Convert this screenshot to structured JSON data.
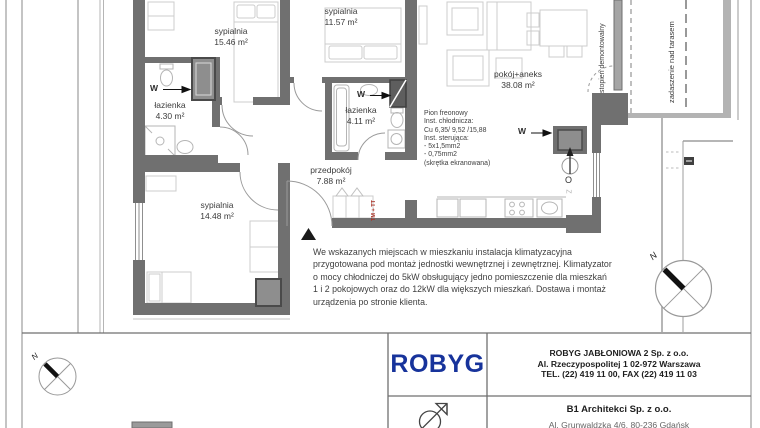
{
  "floor_plan": {
    "rooms": [
      {
        "name": "sypialnia",
        "area": "15.46 m²"
      },
      {
        "name": "sypialnia",
        "area": "11.57 m²"
      },
      {
        "name": "łazienka",
        "area": "4.30 m²"
      },
      {
        "name": "łazienka",
        "area": "4.11 m²"
      },
      {
        "name": "sypialnia",
        "area": "14.48 m²"
      },
      {
        "name": "przedpokój",
        "area": "7.88 m²"
      },
      {
        "name": "pokój+aneks",
        "area": "38.08 m²"
      }
    ],
    "shaft_label": "W",
    "vent_label": "O",
    "sink_label": "Z",
    "riser_label": "TM + TT",
    "north_label": "N",
    "removable_step_label": "stopień demontowalny",
    "terrace_roof_label": "zadaszenie nad tarasem",
    "freon_note_lines": [
      "Pion freonowy",
      "Inst. chłodnicza:",
      "Cu 6,35/ 9,52 /15,88",
      "Inst. sterująca:",
      "- 5x1,5mm2",
      "- 0,75mm2",
      "(skrętka ekranowana)"
    ],
    "hvac_note_lines": [
      "We wskazanych miejscach w mieszkaniu instalacja klimatyzacyjna",
      "przygotowana pod montaż jednostki wewnętrznej i zewnętrznej. Klimatyzator",
      "o mocy chłodniczej do 5kW obsługujący jedno pomieszczenie dla mieszkań",
      "1 i 2 pokojowych oraz do 12kW dla większych mieszkań. Dostawa i montaż",
      "urządzenia po stronie klienta."
    ]
  },
  "title_block": {
    "developer_logo_text": "ROBYG",
    "developer_name": "ROBYG JABŁONIOWA 2 Sp. z o.o.",
    "developer_address": "Al. Rzeczypospolitej 1  02-972 Warszawa",
    "developer_phone": "TEL. (22) 419 11 00, FAX (22) 419 11 03",
    "architect_name": "B1 Architekci Sp. z o.o.",
    "architect_address": "Al. Grunwaldzka 4/6, 80-236 Gdańsk"
  },
  "colors": {
    "wall": "#707070",
    "logo_blue": "#17339b",
    "riser_red": "#a93226"
  }
}
